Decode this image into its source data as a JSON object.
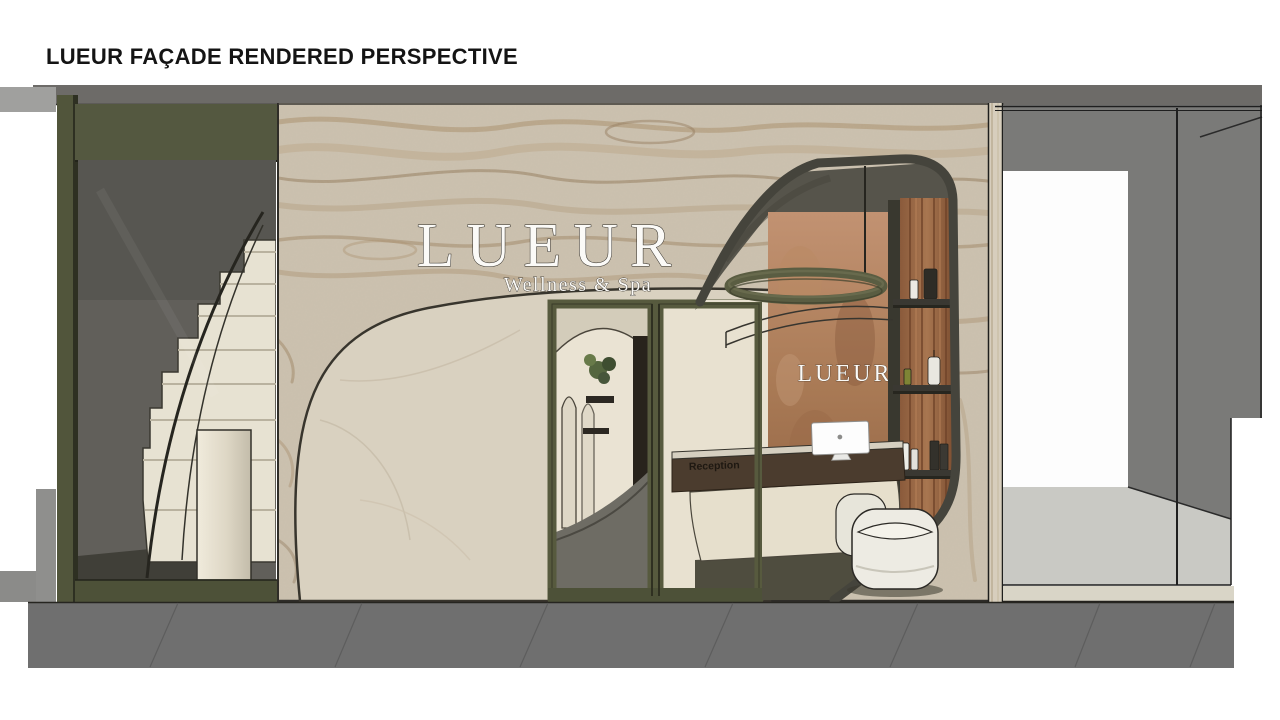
{
  "slide": {
    "title": "LUEUR FAÇADE RENDERED PERSPECTIVE"
  },
  "storefront": {
    "sign_brand": "LUEUR",
    "sign_tagline": "Wellness & Spa",
    "interior_wall_sign": "LUEUR",
    "reception_desk_label": "Reception"
  },
  "palette": {
    "fascia_gray": "#6d6b68",
    "olive_green": "#555840",
    "olive_dark": "#4d5138",
    "marble_beige": "#ccc2b0",
    "marble_vein_tan": "#a98f6c",
    "smooth_marble": "#d9d1c0",
    "copper_wall": "#a97a55",
    "wood_slats": "#9c6b49",
    "desk_wood": "#4b3c2e",
    "interior_cream": "#e8e1d0",
    "interior_dark_wall": "#615f5a",
    "stair_cream": "#e7e2d2",
    "neighbor_gray": "#7a7a78",
    "neighbor_floor": "#c9c9c4",
    "sidewalk_gray": "#6f6f6f",
    "sign_white": "#fbfaf7"
  }
}
